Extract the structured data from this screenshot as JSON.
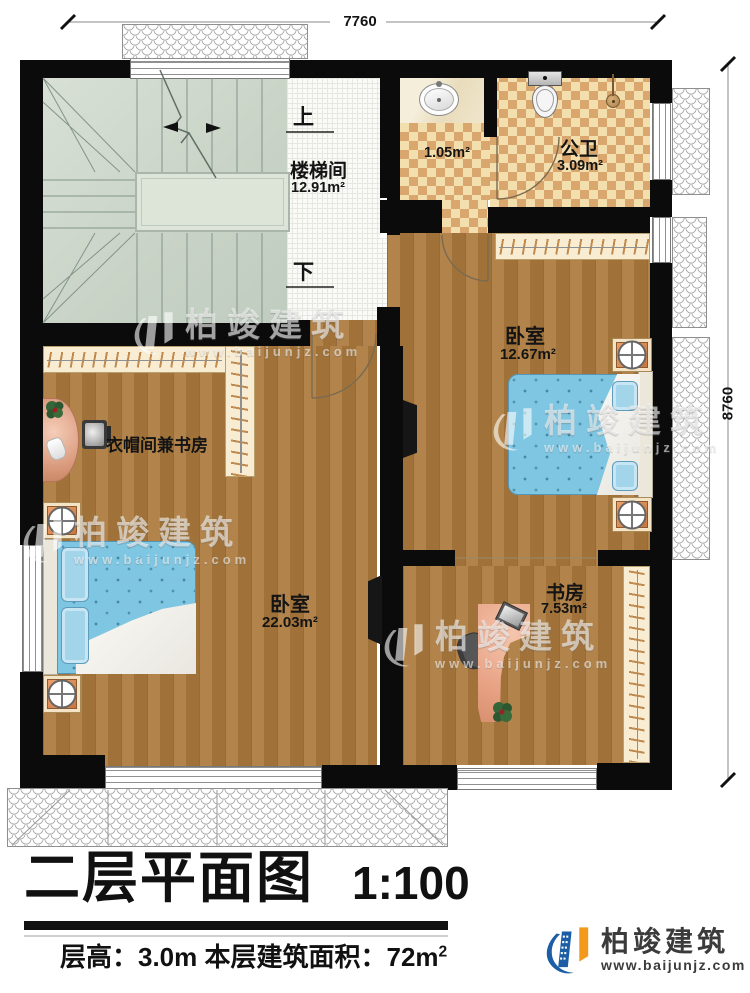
{
  "dimensions": {
    "top": "7760",
    "right": "8760"
  },
  "stairwell": {
    "name": "楼梯间",
    "area": "12.91m²",
    "up": "上",
    "down": "下"
  },
  "bath": {
    "vanity_area": "1.05m²",
    "name": "公卫",
    "area": "3.09m²"
  },
  "bedroom_right": {
    "name": "卧室",
    "area": "12.67m²"
  },
  "cloakroom": {
    "name": "衣帽间兼书房"
  },
  "bedroom_left": {
    "name": "卧室",
    "area": "22.03m²"
  },
  "study": {
    "name": "书房",
    "area": "7.53m²"
  },
  "watermark": {
    "brand": "柏竣建筑",
    "url": "www.baijunjz.com"
  },
  "footer": {
    "title": "二层平面图",
    "scale": "1:100",
    "info": "层高：3.0m  本层建筑面积：72m",
    "info_sup": "2",
    "brand": "柏竣建筑",
    "url": "www.baijunjz.com"
  },
  "colors": {
    "wood": "#ac7b3e",
    "bed_blue": "#7fc6e2",
    "checker_tan": "#d9a76d",
    "stair_sage": "#cdd7cc",
    "wardrobe_cream": "#f8edd3",
    "logo_blue": "#1b5ea6",
    "logo_orange": "#f29a1d"
  }
}
